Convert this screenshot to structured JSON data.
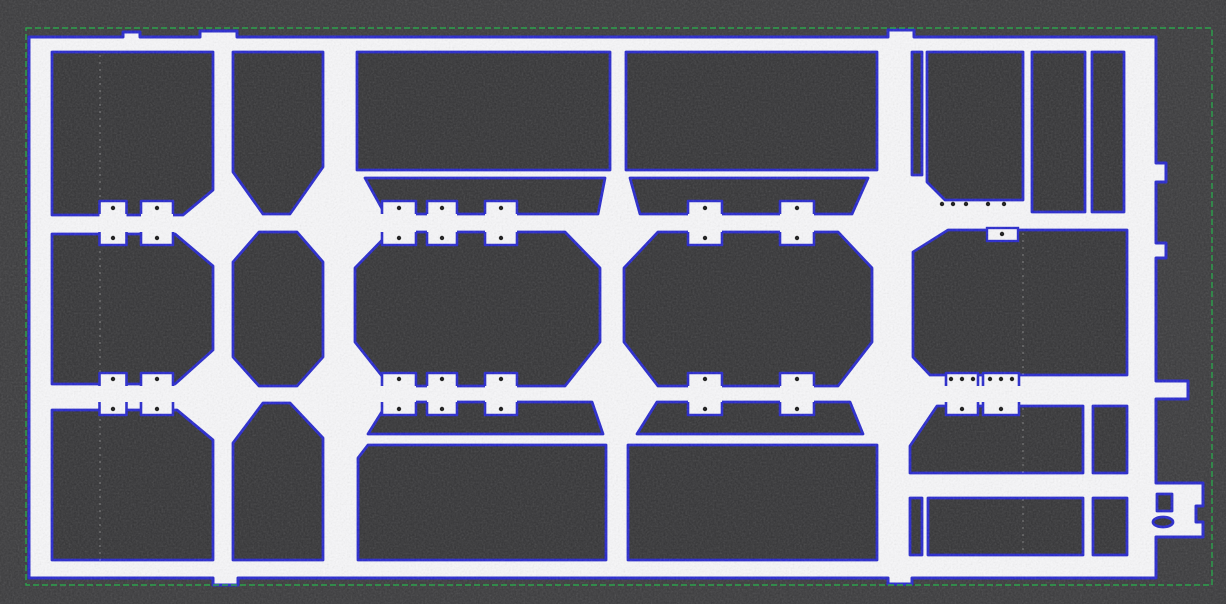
{
  "canvas": {
    "width": 1226,
    "height": 604
  },
  "colors": {
    "background": "#3a3a3c",
    "background_noise_tint": "#808080",
    "plate_fill": "#f7f7f9",
    "hole_fill": "#343436",
    "contour_blue": "#2526cd",
    "bounding_box_green": "#2ca24c",
    "pad_dot": "#161616",
    "streak_white": "#ffffff"
  },
  "overlays": {
    "bounding_box": {
      "x": 26,
      "y": 28,
      "width": 1186,
      "height": 557,
      "dash": [
        6,
        3
      ],
      "stroke_width": 1.4
    },
    "contour_stroke_width": 3
  },
  "plate_outline": [
    [
      29,
      37
    ],
    [
      123,
      37
    ],
    [
      123,
      32
    ],
    [
      140,
      32
    ],
    [
      140,
      37
    ],
    [
      200,
      37
    ],
    [
      200,
      31
    ],
    [
      237,
      31
    ],
    [
      237,
      37
    ],
    [
      888,
      37
    ],
    [
      888,
      30
    ],
    [
      914,
      30
    ],
    [
      914,
      37
    ],
    [
      1156,
      37
    ],
    [
      1156,
      163
    ],
    [
      1166,
      163
    ],
    [
      1166,
      182
    ],
    [
      1156,
      182
    ],
    [
      1156,
      243
    ],
    [
      1166,
      243
    ],
    [
      1166,
      258
    ],
    [
      1156,
      258
    ],
    [
      1156,
      381
    ],
    [
      1188,
      381
    ],
    [
      1188,
      399
    ],
    [
      1156,
      399
    ],
    [
      1156,
      483
    ],
    [
      1203,
      483
    ],
    [
      1203,
      506
    ],
    [
      1196,
      506
    ],
    [
      1196,
      522
    ],
    [
      1203,
      522
    ],
    [
      1203,
      537
    ],
    [
      1156,
      537
    ],
    [
      1156,
      578
    ],
    [
      912,
      578
    ],
    [
      912,
      584
    ],
    [
      888,
      584
    ],
    [
      888,
      578
    ],
    [
      238,
      578
    ],
    [
      238,
      585
    ],
    [
      213,
      585
    ],
    [
      213,
      578
    ],
    [
      29,
      578
    ]
  ],
  "holes": [
    {
      "name": "col-a-top-opening",
      "pts": [
        [
          52,
          52
        ],
        [
          213,
          52
        ],
        [
          213,
          190
        ],
        [
          183,
          215
        ],
        [
          52,
          215
        ]
      ]
    },
    {
      "name": "col-b-top-opening",
      "pts": [
        [
          233,
          52
        ],
        [
          323,
          52
        ],
        [
          323,
          167
        ],
        [
          290,
          214
        ],
        [
          263,
          214
        ],
        [
          233,
          172
        ]
      ]
    },
    {
      "name": "col-c-top-opening",
      "pts": [
        [
          357,
          52
        ],
        [
          610,
          52
        ],
        [
          610,
          170
        ],
        [
          357,
          170
        ]
      ]
    },
    {
      "name": "col-d-top-opening",
      "pts": [
        [
          626,
          52
        ],
        [
          877,
          52
        ],
        [
          877,
          170
        ],
        [
          626,
          170
        ]
      ]
    },
    {
      "name": "rail-de-thin-slot",
      "pts": [
        [
          912,
          52
        ],
        [
          922,
          52
        ],
        [
          922,
          175
        ],
        [
          912,
          175
        ]
      ]
    },
    {
      "name": "sec-e-top-opening",
      "pts": [
        [
          927,
          52
        ],
        [
          1023,
          52
        ],
        [
          1023,
          200
        ],
        [
          945,
          200
        ],
        [
          927,
          182
        ]
      ]
    },
    {
      "name": "sec-e-top-slot-1",
      "pts": [
        [
          1032,
          52
        ],
        [
          1085,
          52
        ],
        [
          1085,
          212
        ],
        [
          1032,
          212
        ]
      ]
    },
    {
      "name": "sec-e-top-slot-2",
      "pts": [
        [
          1092,
          52
        ],
        [
          1124,
          52
        ],
        [
          1124,
          212
        ],
        [
          1092,
          212
        ]
      ]
    },
    {
      "name": "col-c-upper-trapezoid",
      "pts": [
        [
          365,
          178
        ],
        [
          605,
          178
        ],
        [
          598,
          214
        ],
        [
          385,
          214
        ]
      ]
    },
    {
      "name": "col-d-upper-trapezoid",
      "pts": [
        [
          630,
          178
        ],
        [
          868,
          178
        ],
        [
          852,
          214
        ],
        [
          640,
          214
        ]
      ]
    },
    {
      "name": "col-a-octagon",
      "pts": [
        [
          52,
          234
        ],
        [
          175,
          234
        ],
        [
          213,
          266
        ],
        [
          213,
          350
        ],
        [
          175,
          384
        ],
        [
          52,
          384
        ]
      ]
    },
    {
      "name": "col-b-octagon",
      "pts": [
        [
          259,
          232
        ],
        [
          297,
          232
        ],
        [
          323,
          262
        ],
        [
          323,
          357
        ],
        [
          297,
          386
        ],
        [
          259,
          386
        ],
        [
          233,
          357
        ],
        [
          233,
          262
        ]
      ]
    },
    {
      "name": "col-c-octagon",
      "pts": [
        [
          390,
          232
        ],
        [
          565,
          232
        ],
        [
          600,
          268
        ],
        [
          600,
          342
        ],
        [
          565,
          386
        ],
        [
          390,
          386
        ],
        [
          355,
          342
        ],
        [
          355,
          268
        ]
      ]
    },
    {
      "name": "col-d-octagon",
      "pts": [
        [
          658,
          232
        ],
        [
          838,
          232
        ],
        [
          872,
          268
        ],
        [
          872,
          342
        ],
        [
          838,
          386
        ],
        [
          658,
          386
        ],
        [
          624,
          342
        ],
        [
          624,
          268
        ]
      ]
    },
    {
      "name": "sec-e-middle-opening",
      "pts": [
        [
          948,
          230
        ],
        [
          1127,
          230
        ],
        [
          1127,
          375
        ],
        [
          930,
          375
        ],
        [
          913,
          357
        ],
        [
          913,
          252
        ]
      ]
    },
    {
      "name": "col-c-lower-trapezoid",
      "pts": [
        [
          388,
          402
        ],
        [
          592,
          402
        ],
        [
          603,
          434
        ],
        [
          368,
          434
        ]
      ]
    },
    {
      "name": "col-d-lower-trapezoid",
      "pts": [
        [
          657,
          402
        ],
        [
          850,
          402
        ],
        [
          863,
          434
        ],
        [
          637,
          434
        ]
      ]
    },
    {
      "name": "col-a-bottom-opening",
      "pts": [
        [
          52,
          410
        ],
        [
          177,
          410
        ],
        [
          213,
          440
        ],
        [
          213,
          560
        ],
        [
          52,
          560
        ]
      ]
    },
    {
      "name": "col-b-bottom-opening",
      "pts": [
        [
          263,
          403
        ],
        [
          290,
          403
        ],
        [
          323,
          438
        ],
        [
          323,
          560
        ],
        [
          233,
          560
        ],
        [
          233,
          443
        ]
      ]
    },
    {
      "name": "col-c-bottom-opening",
      "pts": [
        [
          368,
          445
        ],
        [
          606,
          445
        ],
        [
          606,
          560
        ],
        [
          358,
          560
        ],
        [
          358,
          458
        ]
      ]
    },
    {
      "name": "col-d-bottom-opening",
      "pts": [
        [
          628,
          445
        ],
        [
          877,
          445
        ],
        [
          877,
          560
        ],
        [
          628,
          560
        ]
      ]
    },
    {
      "name": "sec-e-lower-band1",
      "pts": [
        [
          937,
          406
        ],
        [
          1083,
          406
        ],
        [
          1083,
          473
        ],
        [
          910,
          473
        ],
        [
          910,
          446
        ]
      ]
    },
    {
      "name": "sec-e-lower-band1-slot",
      "pts": [
        [
          1093,
          406
        ],
        [
          1127,
          406
        ],
        [
          1127,
          473
        ],
        [
          1093,
          473
        ]
      ]
    },
    {
      "name": "sec-e-lower-band2-slot-left",
      "pts": [
        [
          910,
          498
        ],
        [
          922,
          498
        ],
        [
          922,
          555
        ],
        [
          910,
          555
        ]
      ]
    },
    {
      "name": "sec-e-lower-band2-rect",
      "pts": [
        [
          928,
          498
        ],
        [
          1083,
          498
        ],
        [
          1083,
          555
        ],
        [
          928,
          555
        ]
      ]
    },
    {
      "name": "sec-e-lower-band2-slot-right",
      "pts": [
        [
          1093,
          498
        ],
        [
          1127,
          498
        ],
        [
          1127,
          555
        ],
        [
          1093,
          555
        ]
      ]
    },
    {
      "name": "connector-square-hole",
      "pts": [
        [
          1157,
          494
        ],
        [
          1172,
          494
        ],
        [
          1172,
          511
        ],
        [
          1157,
          511
        ]
      ]
    }
  ],
  "ellipse_holes": [
    {
      "name": "connector-oval-hole",
      "cx": 1163,
      "cy": 522,
      "rx": 10,
      "ry": 5
    }
  ],
  "tie_bar_rows": [
    {
      "name": "upper-tie-bar",
      "yc": 223,
      "rail_half": 9,
      "pad_half": 22,
      "dot_offset": 15,
      "pads": [
        {
          "xc": 113,
          "w": 27
        },
        {
          "xc": 157,
          "w": 32
        },
        {
          "xc": 399,
          "w": 34
        },
        {
          "xc": 442,
          "w": 30
        },
        {
          "xc": 501,
          "w": 32
        },
        {
          "xc": 705,
          "w": 34
        },
        {
          "xc": 797,
          "w": 34
        }
      ],
      "dot_row": {
        "y": 204,
        "xs": [
          942,
          953,
          966,
          988,
          1004
        ]
      },
      "tabs": [
        {
          "x": 987,
          "y": 228,
          "w": 31,
          "h": 13,
          "dots": [
            [
              1002,
              234
            ]
          ]
        }
      ]
    },
    {
      "name": "lower-tie-bar",
      "yc": 394,
      "rail_half": 8,
      "pad_half": 21,
      "dot_offset": 15,
      "pads": [
        {
          "xc": 113,
          "w": 27
        },
        {
          "xc": 157,
          "w": 32
        },
        {
          "xc": 399,
          "w": 34
        },
        {
          "xc": 442,
          "w": 30
        },
        {
          "xc": 501,
          "w": 32
        },
        {
          "xc": 705,
          "w": 34
        },
        {
          "xc": 797,
          "w": 34
        },
        {
          "xc": 962,
          "w": 32,
          "extra_dots": true
        },
        {
          "xc": 1001,
          "w": 36,
          "extra_dots": true
        }
      ],
      "extra_dot_offsets": [
        [
          -11,
          -15
        ],
        [
          11,
          -15
        ]
      ]
    }
  ],
  "scan_streaks": [
    {
      "x": 34,
      "y1": 42,
      "y2": 572
    },
    {
      "x": 100,
      "y1": 55,
      "y2": 565
    },
    {
      "x": 892,
      "y1": 40,
      "y2": 574
    },
    {
      "x": 1023,
      "y1": 212,
      "y2": 555
    }
  ],
  "noise": {
    "base_frequency": 0.55,
    "octaves": 3,
    "opacity": 0.18,
    "seed": 7
  }
}
